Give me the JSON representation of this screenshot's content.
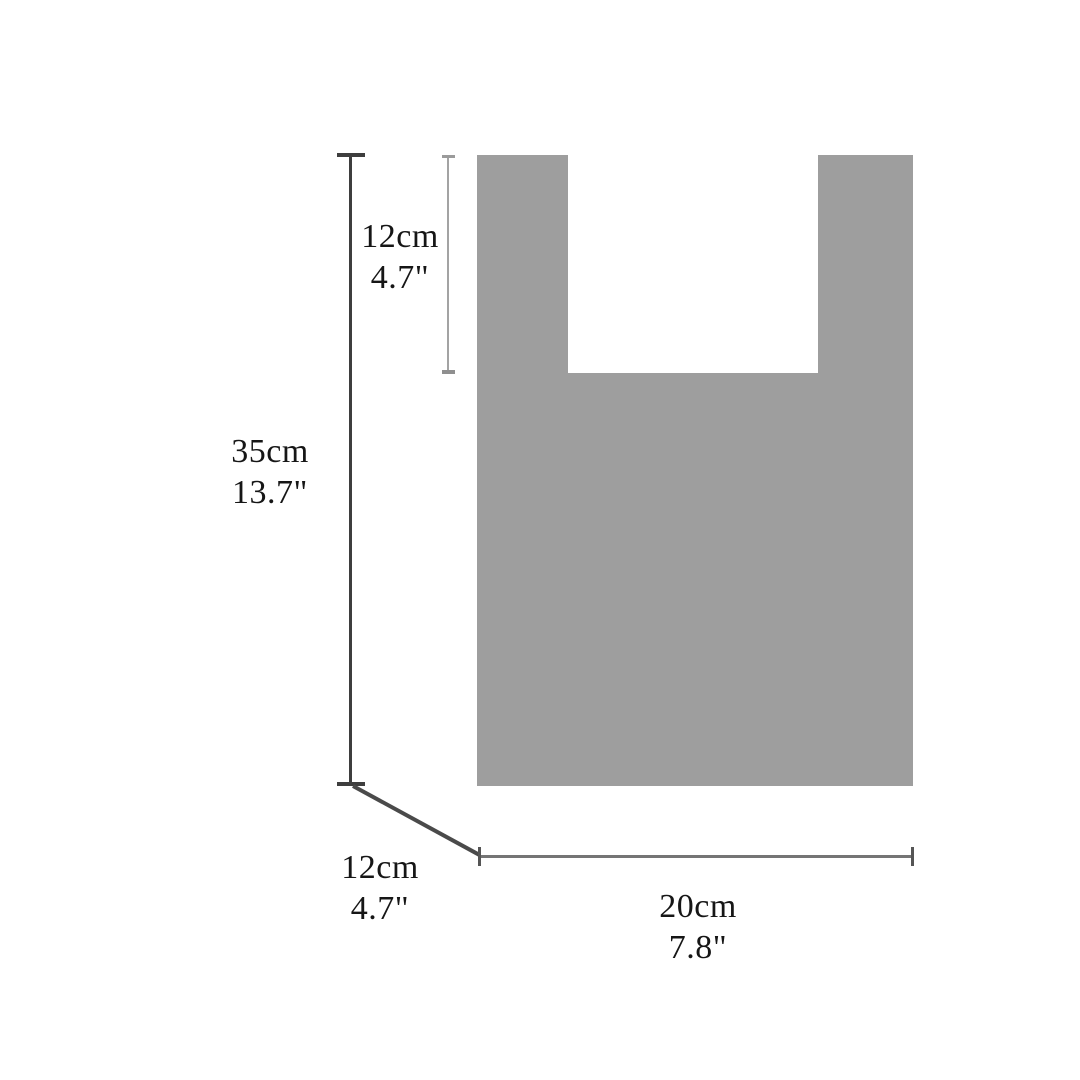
{
  "diagram": {
    "subject": "bag-dimension-diagram",
    "measurements": {
      "handle_depth": {
        "cm": "12cm",
        "inches": "4.7\""
      },
      "height": {
        "cm": "35cm",
        "inches": "13.7\""
      },
      "bottom_gusset": {
        "cm": "12cm",
        "inches": "4.7\""
      },
      "width": {
        "cm": "20cm",
        "inches": "7.8\""
      }
    },
    "colors": {
      "bag_fill": "#9e9e9e",
      "dimension_line_dark": "#3e3e3e",
      "dimension_line_light": "#a3a3a3",
      "dimension_line_mid": "#757575",
      "text": "#161616",
      "background": "#ffffff"
    }
  }
}
